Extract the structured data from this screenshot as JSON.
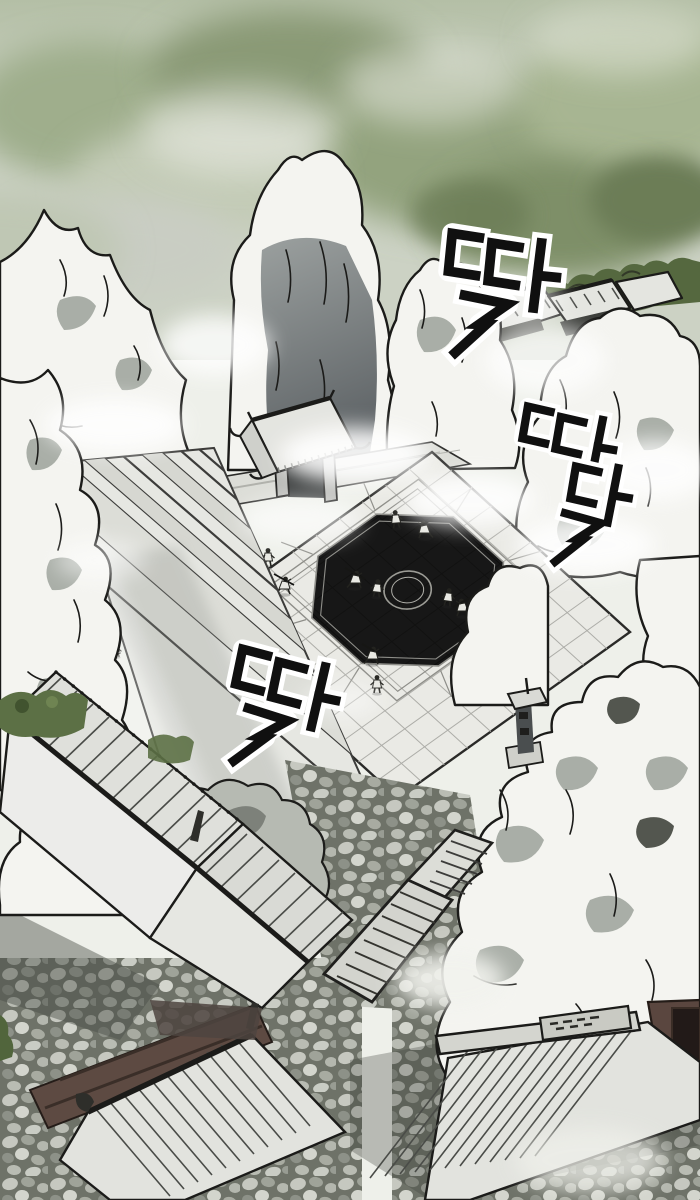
{
  "panel": {
    "kind": "manhwa art panel",
    "setting": "aerial view of a mountain sect training courtyard"
  },
  "sfx": {
    "top_right": "딱",
    "right": "따닥",
    "mid_left": "딱"
  },
  "ridge_sign": {
    "text": "illegible carved glyphs"
  },
  "colors": {
    "paper": "#eef0ea",
    "ink": "#1b1b19",
    "mist_green": "#a7b592",
    "mist_green_dark": "#6c7d57",
    "mist_gray": "#c6cac2",
    "rock_light": "#f4f4f0",
    "rock_shadow": "#a9aea7",
    "rock_face_dark": "#62676a",
    "courtyard_tile": "#eaeae5",
    "tile_line": "#adada8",
    "roof_gray": "#e4e5e0",
    "wall_maroon": "#5d4a42",
    "foliage": "#55683f",
    "cobble_gap": "#6e7268"
  }
}
